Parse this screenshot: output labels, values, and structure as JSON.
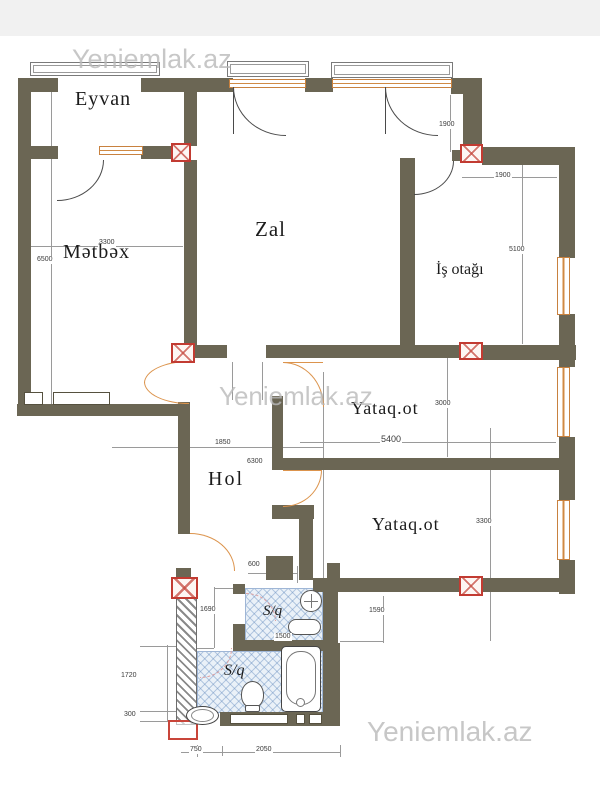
{
  "watermark": {
    "text": "Yeniemlak.az"
  },
  "rooms": {
    "eyvan": "Eyvan",
    "zal": "Zal",
    "metbex": "Mətbəx",
    "is_otagi": "İş otağı",
    "yataq_1": "Yataq.ot",
    "hol": "Hol",
    "yataq_2": "Yataq.ot",
    "sq_1": "S/q",
    "sq_2": "S/q"
  },
  "dims": {
    "zal_window_h": "1900",
    "is_otagi_w": "1900",
    "metbex_h": "6500",
    "metbex_w": "3300",
    "is_otagi_h": "5100",
    "yataq1_h": "3000",
    "yataq1_w": "5400",
    "hol_w": "1850",
    "hol_h": "6300",
    "yataq2_h": "3300",
    "corridor_w": "600",
    "vestibule_h": "1690",
    "sq1_w": "1500",
    "sq_right": "1590",
    "sq2_h": "1720",
    "sq2_offset": "300",
    "sq2_left_w": "750",
    "sq2_w": "2050"
  },
  "colors": {
    "wall": "#6b6654",
    "window_frame": "#c8813f",
    "door_arc": "#dc944d",
    "column_marker": "#c23b32",
    "bath_hatch": "#9fb6d6",
    "label": "#1b1b1b",
    "dimension": "#3a3a3a",
    "watermark": "#bdbdbd"
  }
}
